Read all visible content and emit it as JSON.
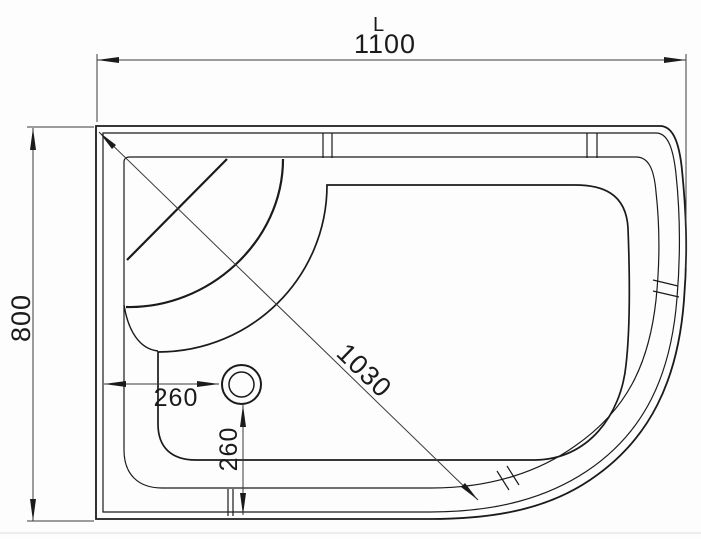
{
  "drawing": {
    "type_label": "shower-tray-plan-view",
    "length_symbol": "L",
    "overall_width_mm": "1100",
    "overall_depth_mm": "800",
    "diagonal_mm": "1030",
    "drain_offset_horizontal_mm": "260",
    "drain_offset_vertical_mm": "260",
    "colors": {
      "line": "#1b1b1b",
      "dimension_line": "#3a3a3a",
      "background": "#fdfdfd"
    }
  }
}
